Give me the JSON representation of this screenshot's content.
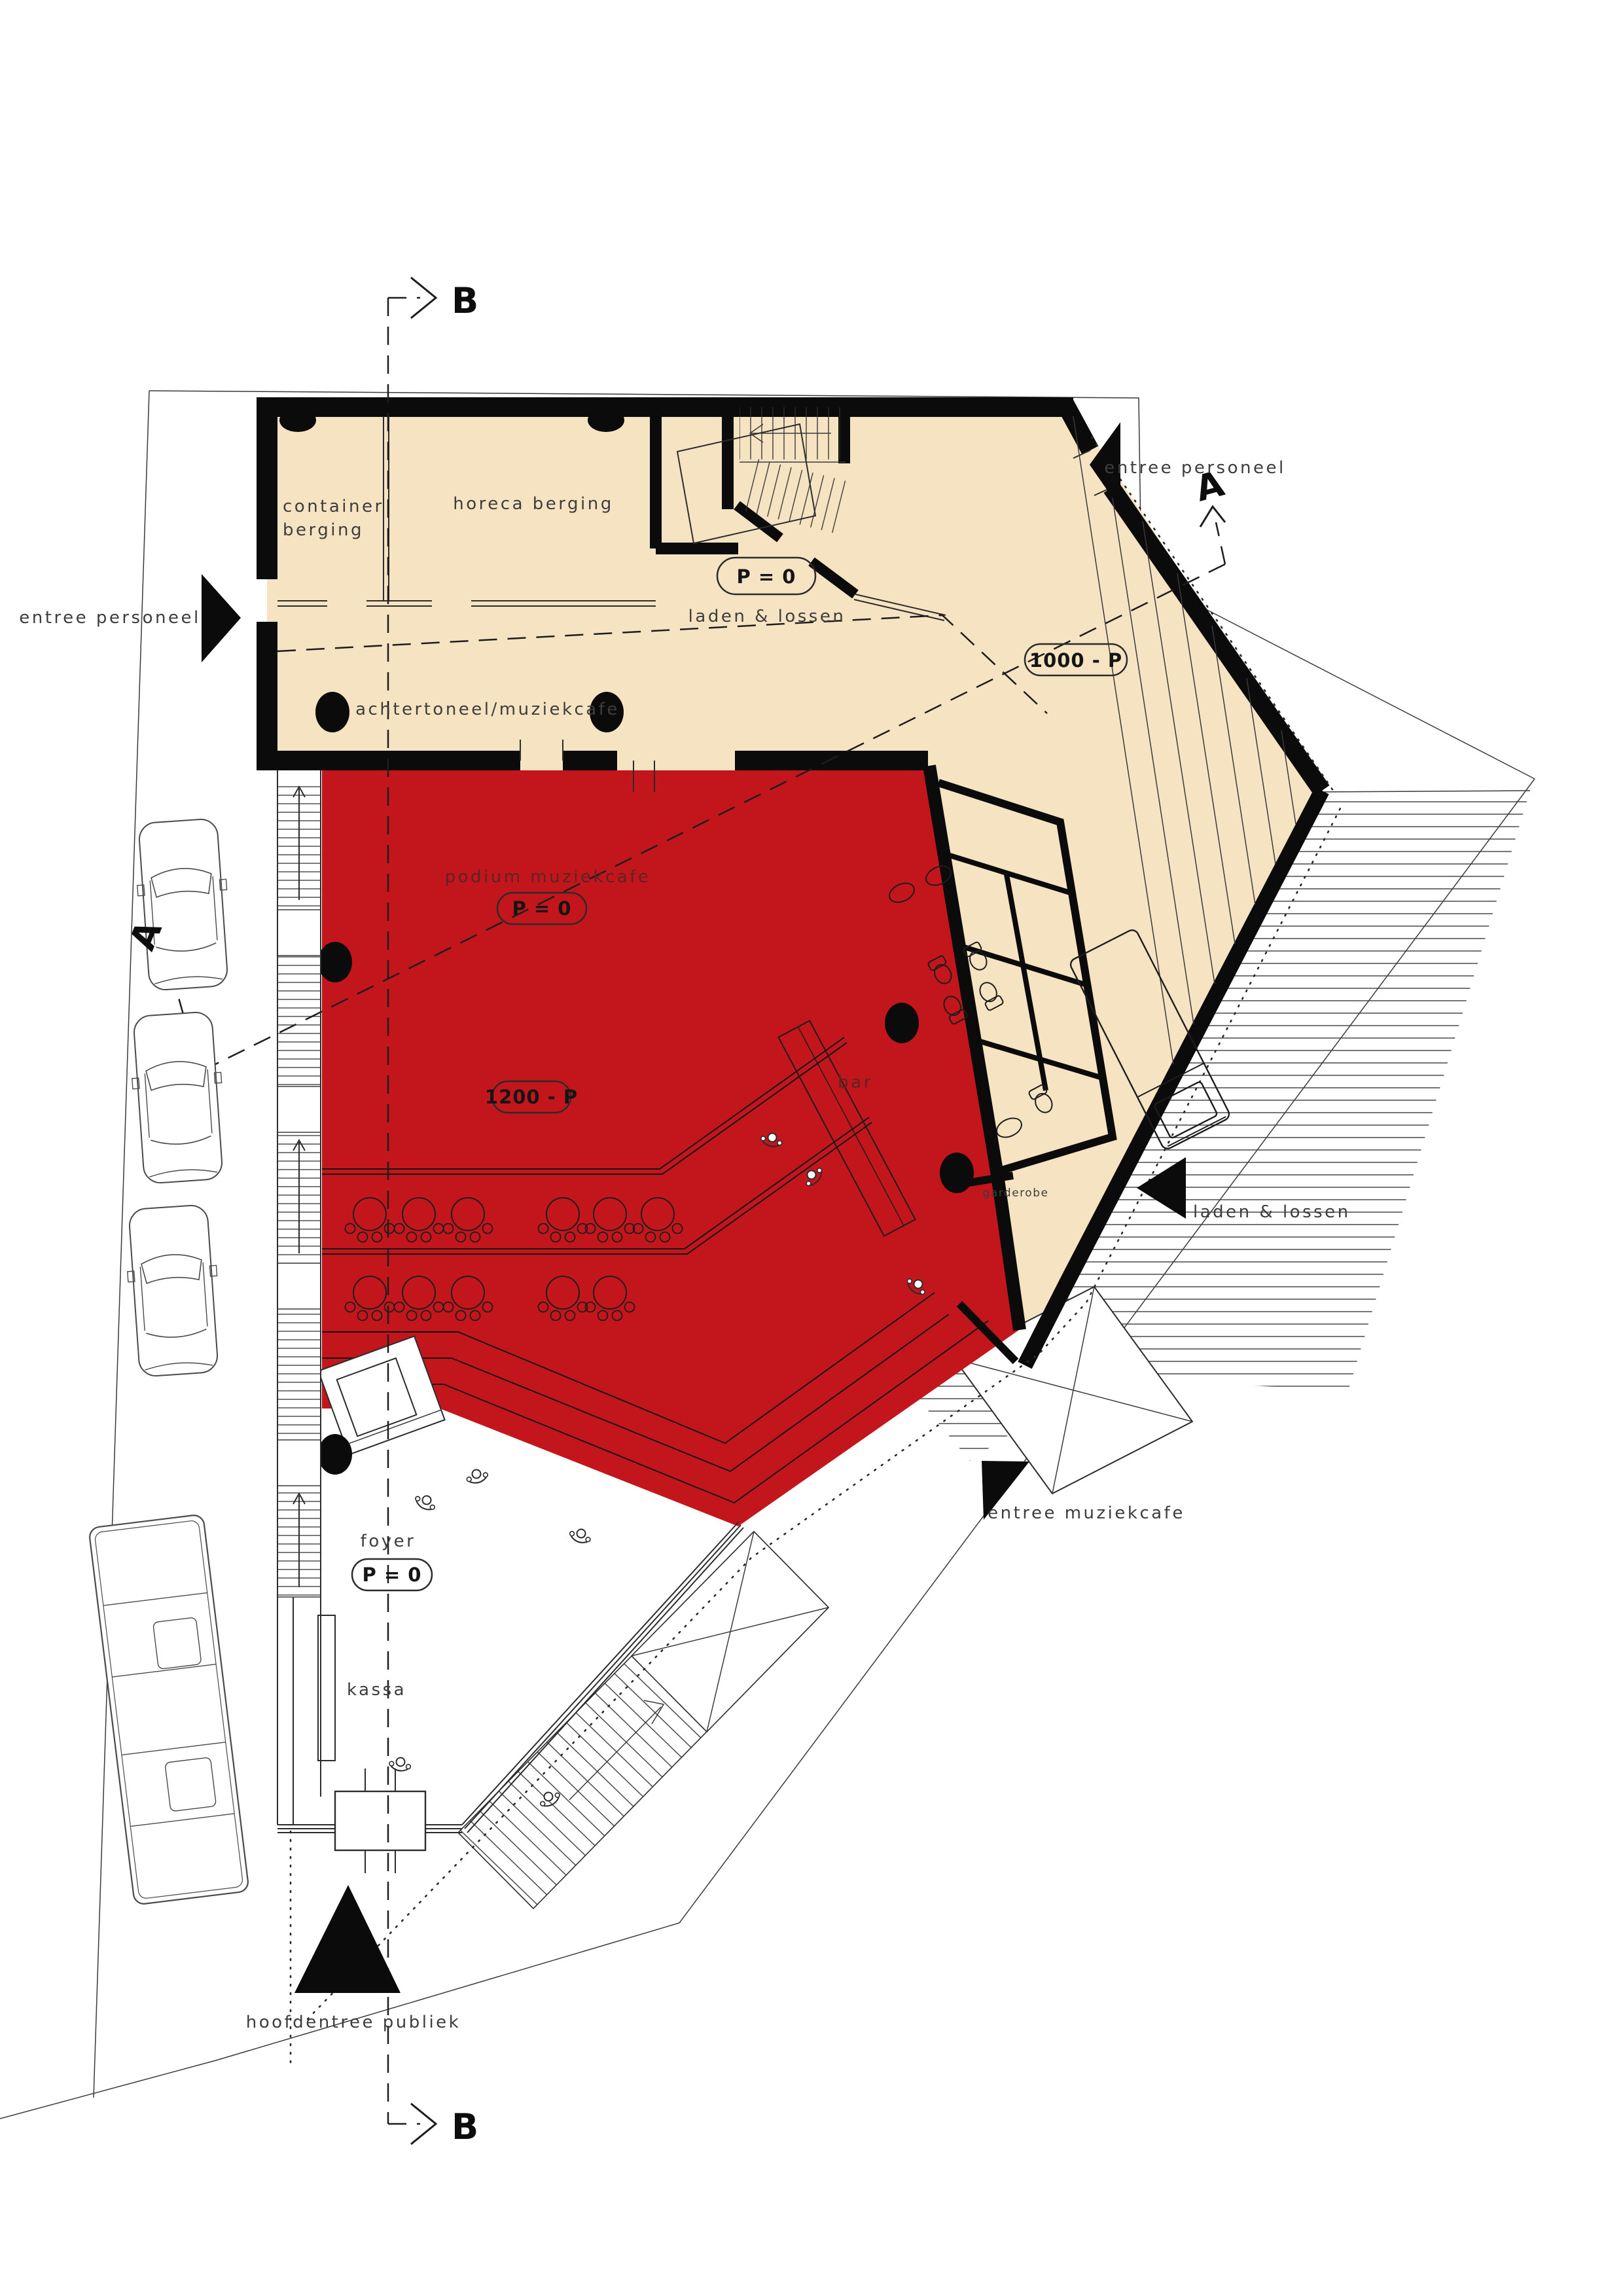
{
  "title": "floor plan - muziekcafe ground level",
  "colors": {
    "hall_red": "#c3161c",
    "floor_cream": "#f6e3c2",
    "wall_black": "#0b0b0b",
    "line_gray": "#3a3a3a",
    "label_gray": "#3d3d3d"
  },
  "labels": {
    "section_b": "B",
    "section_a": "A",
    "entree_personeel": "entree personeel",
    "container_l1": "container",
    "container_l2": "berging",
    "horeca": "horeca berging",
    "p0": "P = 0",
    "laden_lossen": "laden & lossen",
    "cap_1000": "1000 - P",
    "achtertoneel": "achtertoneel/muziekcafe",
    "podium": "podium muziekcafe",
    "cap_1200": "1200 - P",
    "bar": "bar",
    "garderobe": "garderobe",
    "entree_muziekcafe": "entree muziekcafe",
    "foyer": "foyer",
    "kassa": "kassa",
    "hoofdentree": "hoofdentree publiek"
  }
}
